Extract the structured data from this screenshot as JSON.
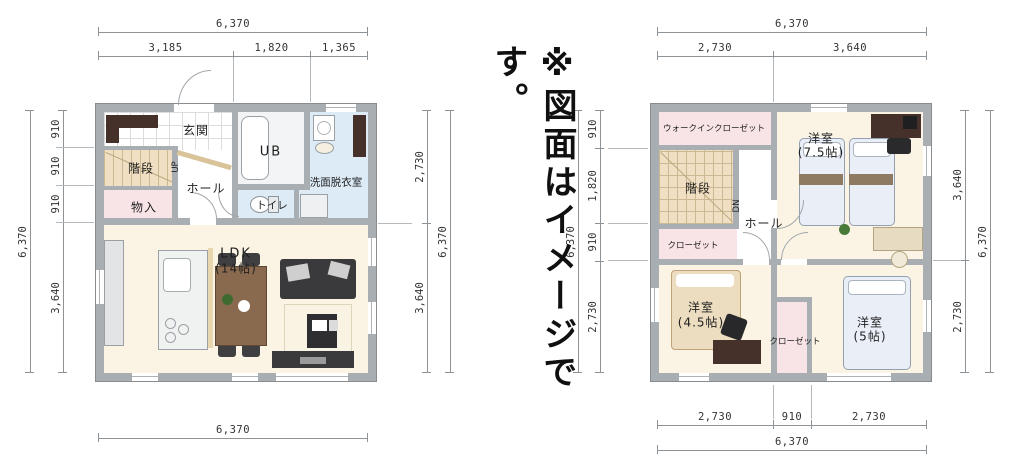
{
  "note": "※図面はイメージです。",
  "floor1": {
    "rooms": {
      "genkan": "玄関",
      "stairs": "階段",
      "up": "UP",
      "hall": "ホール",
      "storage": "物入",
      "ub": "UB",
      "washroom": "洗面脱衣室",
      "toilet": "トイレ",
      "ldk": "LDK",
      "ldk_size": "(14帖)"
    },
    "dims": {
      "top_total": "6,370",
      "top_segments": [
        "3,185",
        "1,820",
        "1,365"
      ],
      "left_total": "6,370",
      "left_segments": [
        "910",
        "910",
        "910",
        "3,640"
      ],
      "right_segments": [
        "2,730",
        "3,640"
      ],
      "right_total": "6,370",
      "bottom_total": "6,370"
    }
  },
  "floor2": {
    "rooms": {
      "wic": "ウォークインクローゼット",
      "stairs": "階段",
      "dn": "DN",
      "hall": "ホール",
      "closet_left": "クローゼット",
      "bedroom75": "洋室",
      "bedroom75_size": "(7.5帖)",
      "bedroom45": "洋室",
      "bedroom45_size": "(4.5帖)",
      "closet_mid": "クローゼット",
      "bedroom5": "洋室",
      "bedroom5_size": "(5帖)"
    },
    "dims": {
      "top_total": "6,370",
      "top_segments": [
        "2,730",
        "3,640"
      ],
      "left_total": "6,370",
      "left_segments": [
        "910",
        "1,820",
        "910",
        "2,730"
      ],
      "right_segments": [
        "3,640",
        "2,730"
      ],
      "right_total": "6,370",
      "bottom_segments": [
        "2,730",
        "910",
        "2,730"
      ],
      "bottom_total": "6,370"
    }
  },
  "colors": {
    "wall_fill": "#a9aeb3",
    "wall_edge": "#878c90",
    "room_cream": "#fbf4e4",
    "closet_pink": "#f8e3e6",
    "water_blue": "#dcebf6",
    "stair_tan": "#f0dfc2",
    "cabinet_dark_brown": "#46312a",
    "furniture_dark": "#3a3a3c",
    "table_brown": "#8a6a4f",
    "bed_blue": "#e9eef7",
    "bed_beige": "#ecdcc0",
    "dimension_text": "#333333"
  }
}
